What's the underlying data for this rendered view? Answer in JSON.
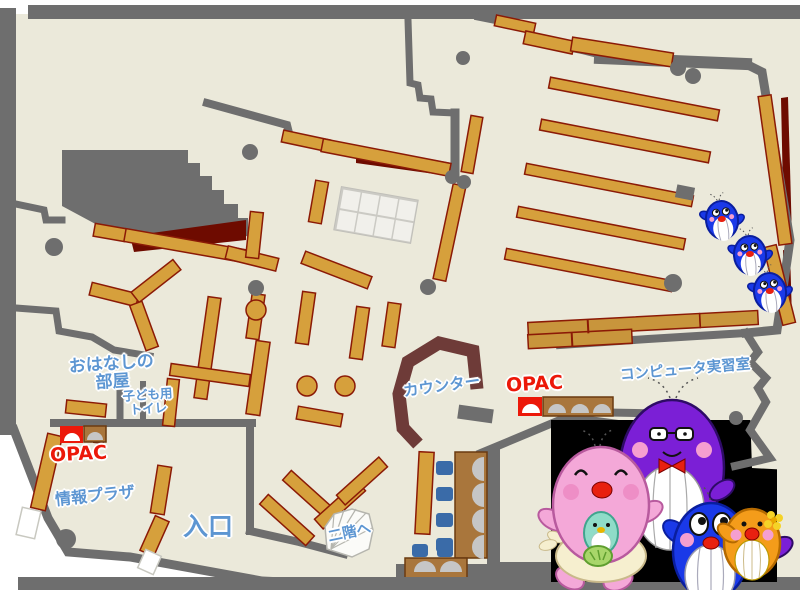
{
  "map": {
    "name": "library-first-floor-map",
    "labels": {
      "story_room_line1": "おはなしの",
      "story_room_line2": "部屋",
      "kids_toilet_line1": "子ども用",
      "kids_toilet_line2": "トイレ",
      "opac_left": "OPAC",
      "opac_center": "OPAC",
      "info_plaza": "情報プラザ",
      "entrance": "入口",
      "stairs_up": "二階へ",
      "counter": "カウンター",
      "computer_room": "コンピュータ実習室"
    },
    "icons": {
      "whale_family": "whale-family-mascots",
      "small_whales": "three-small-blue-whale-mascots"
    },
    "colors": {
      "floor": "#EBE9DA",
      "wall": "#6E6E6E",
      "shelf": "#D6A03C",
      "shelf_border": "#8B1A06",
      "dark_red": "#6E0B00",
      "counter": "#6E3B38",
      "desk": "#A9763C",
      "desk_border": "#6B3A10",
      "chair": "#3A6BA8",
      "monitor": "#C6C6C6",
      "table_tan": "#C8953C",
      "grid_fill": "#F1F0EB",
      "grid_line": "#CBCAC4",
      "label_blue": "#5D96D2",
      "label_red": "#EC1809",
      "panel_black": "#000000",
      "m_pink": "#F4A8D8",
      "m_purple": "#7B1FD6",
      "m_blue": "#1A39E8",
      "m_orange": "#F49C1A",
      "m_teal": "#8FDCC8",
      "m_apron": "#F6EFCF",
      "m_cheek": "#F59FD0",
      "m_red": "#E82010"
    }
  }
}
